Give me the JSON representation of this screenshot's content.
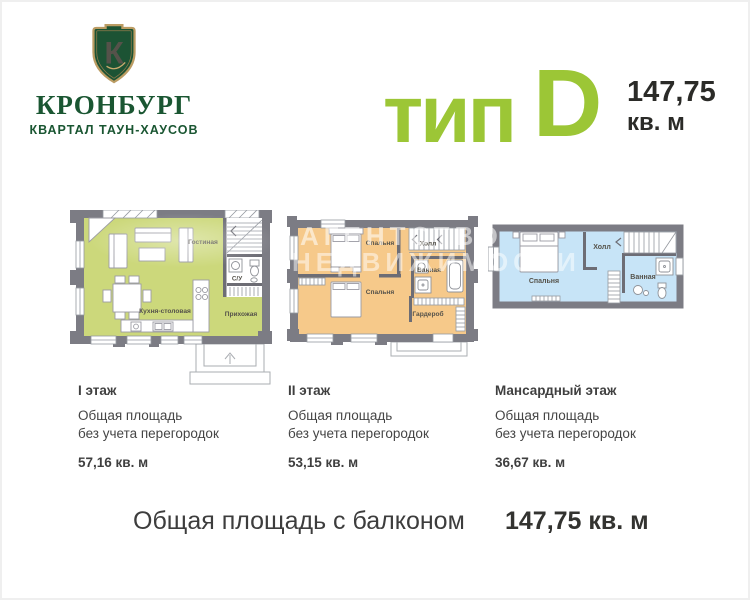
{
  "logo": {
    "monogram": "К",
    "name": "КРОНБУРГ",
    "tagline": "КВАРТАЛ ТАУН-ХАУСОВ"
  },
  "header": {
    "type_label": "тип",
    "type_letter": "D",
    "total_area_value": "147,75",
    "total_area_unit": "кв. м"
  },
  "watermark": {
    "line1": "АГЕНТСТВО",
    "line2": "НЕДВИЖИМОСТИ"
  },
  "floors": [
    {
      "name": "I этаж",
      "note_line1": "Общая площадь",
      "note_line2": "без учета перегородок",
      "area": "57,16 кв. м",
      "rooms": {
        "living": "Гостиная",
        "wc": "С/У",
        "kitchen": "Кухня-столовая",
        "hall": "Прихожая"
      }
    },
    {
      "name": "II этаж",
      "note_line1": "Общая площадь",
      "note_line2": "без учета перегородок",
      "area": "53,15 кв. м",
      "rooms": {
        "bedroom1": "Спальня",
        "hall": "Холл",
        "bath": "Ванная",
        "bedroom2": "Спальня",
        "wardrobe": "Гардероб"
      }
    },
    {
      "name": "Мансардный этаж",
      "note_line1": "Общая площадь",
      "note_line2": "без учета перегородок",
      "area": "36,67 кв. м",
      "rooms": {
        "bedroom": "Спальня",
        "hall": "Холл",
        "bath": "Ванная"
      }
    }
  ],
  "footer": {
    "label": "Общая площадь с балконом",
    "value": "147,75 кв. м"
  },
  "colors": {
    "accent_green": "#9cc636",
    "logo_green": "#1a5632",
    "logo_gold": "#bb9c63",
    "floor1_fill": "#ccd87b",
    "floor2_fill": "#f6c98a",
    "floor3_fill": "#c7e4f7",
    "wall_gray": "#7c7c84"
  }
}
